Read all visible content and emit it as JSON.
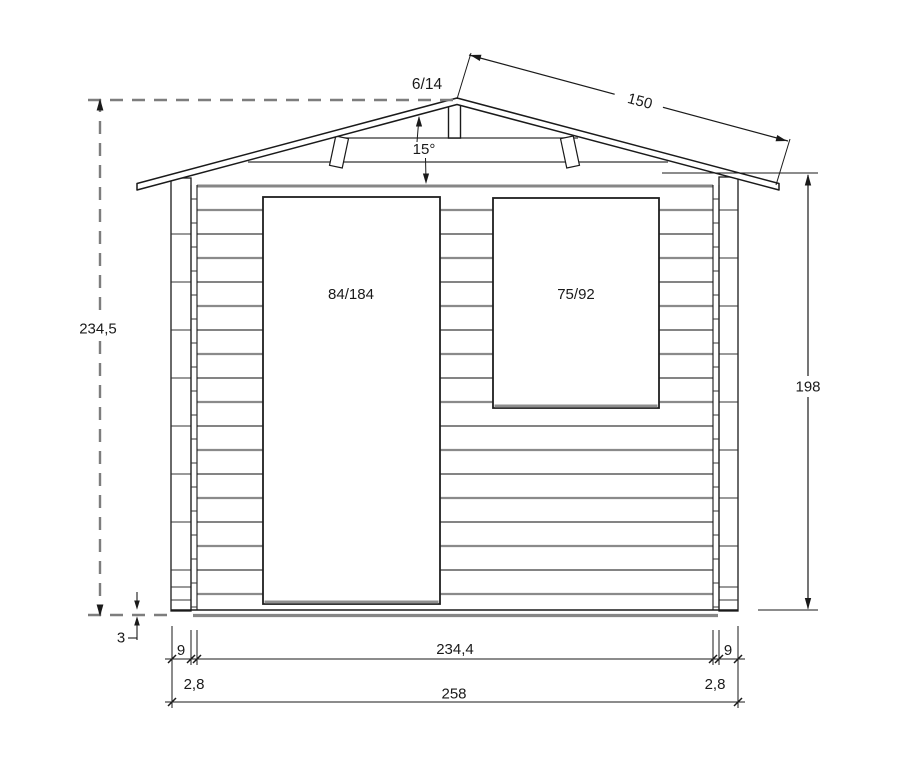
{
  "drawing": {
    "type_note": "shed front elevation technical drawing",
    "roof": {
      "ridge_beam_size": "6/14",
      "rafter_length": "150",
      "pitch_angle": "15°"
    },
    "openings": {
      "door_size": "84/184",
      "window_size": "75/92"
    },
    "dimensions": {
      "overall_height": "234,5",
      "wall_height": "198",
      "floor_thickness": "3",
      "corner_joint_left": "9",
      "corner_joint_right": "9",
      "wall_inner_width": "234,4",
      "wall_plank_left": "2,8",
      "wall_plank_right": "2,8",
      "overall_width": "258"
    },
    "colors": {
      "ink": "#1a1a1a",
      "grey_line": "#8a8a8a",
      "thick_grey": "#868686",
      "dashed_grey": "#7d7d7d",
      "paper": "#ffffff"
    }
  }
}
